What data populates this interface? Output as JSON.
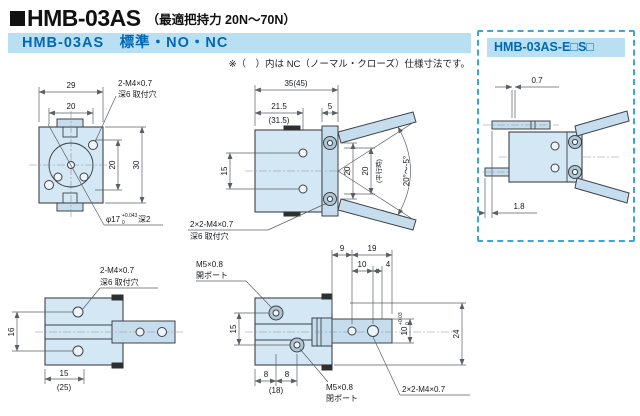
{
  "page": {
    "title": "HMB-03AS",
    "title_note": "（最適把持力 20N～70N）",
    "section_header": "HMB-03AS　標準・NO・NC",
    "nc_note": "※（　）内は NC（ノーマル・クローズ）仕様寸法です。"
  },
  "variant_box": {
    "title": "HMB-03AS-E□S□",
    "dim_top": "0.7",
    "dim_bottom": "1.8"
  },
  "views": {
    "front": {
      "w_outer": "29",
      "w_inner": "20",
      "h_outer": "30",
      "h_inner": "20",
      "mount_thread": "2-M4×0.7",
      "mount_note": "深6 取付穴",
      "boss_dia": "φ17",
      "boss_tol_up": "+0.043",
      "boss_tol_low": "0",
      "boss_depth": "深2"
    },
    "side": {
      "w_total": "35(45)",
      "w_body": "21.5",
      "w_body_nc": "(31.5)",
      "w_flange": "5",
      "h_holes": "15",
      "gap_open": "20",
      "gap_parallel": "20",
      "parallel_note": "(平行時)",
      "angle": "20°～-5°",
      "mount_thread": "2×2-M4×0.7",
      "mount_note": "深6 取付穴"
    },
    "top": {
      "h_holes": "16",
      "w_offset": "15",
      "w_offset_nc": "(25)",
      "mount_thread": "2-M4×0.7",
      "mount_note": "深6 取付穴"
    },
    "ports": {
      "d1": "9",
      "d2": "19",
      "d3": "10",
      "d4": "4",
      "h_ports": "15",
      "b1": "8",
      "b2": "8",
      "b_nc": "(18)",
      "slot": "10",
      "slot_tol_up": "+0.03",
      "slot_tol_low": "0",
      "h_total": "24",
      "open_thread": "M5×0.8",
      "open_label": "開ポート",
      "close_thread": "M5×0.8",
      "close_label": "閉ポート",
      "mount_thread": "2×2-M4×0.7"
    }
  },
  "colors": {
    "accent_blue": "#0068b7",
    "band_bg": "#b9e0f2",
    "dashed_border": "#3aa7db",
    "drawing_fill": "#d4e7f4",
    "line": "#3d4248"
  }
}
